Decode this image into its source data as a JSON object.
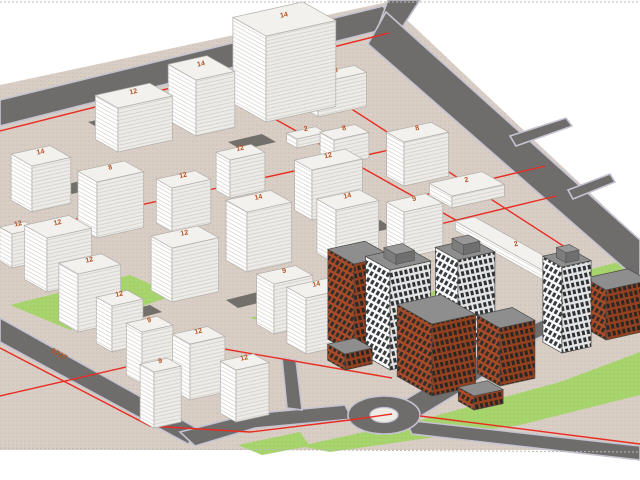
{
  "viewport": {
    "width": 640,
    "height": 480,
    "background": "#ffffff",
    "tool": "3d-massing-model-view"
  },
  "palette": {
    "ground": "#d8cec5",
    "ground_dot": "#c8bbaf",
    "road": "#6e6d6c",
    "road_edge": "#c6c3d0",
    "grass": "#a8d46d",
    "grass_dot": "#97c75c",
    "parcel_line": "#e92c22",
    "massing_top": "#f3f1ee",
    "massing_left": "#ffffff",
    "massing_right": "#edebe8",
    "massing_stroke": "#b3afaa",
    "floor_line": "#d3d0cb",
    "detail_roof": "#8e8e8e",
    "detail_stroke": "#4a4a48",
    "white_facade": "#fafafa",
    "white_window": "#3a3d40",
    "brick_facade": "#a84b28",
    "brick_window": "#332e29",
    "shadow": "#615f5a",
    "label_orange": "#b4531f",
    "frame_dash": "#bdbab6",
    "island_fill": "#efece7"
  },
  "scene": {
    "axes": {
      "u": [
        0.97,
        -0.215
      ],
      "v": [
        0.87,
        0.49
      ]
    },
    "frame_lines": [
      {
        "name": "frame-dash-top",
        "x1": 0,
        "y1": 2,
        "x2": 640,
        "y2": 2
      },
      {
        "name": "frame-dash-bottom",
        "x1": 0,
        "y1": 448,
        "x2": 640,
        "y2": 452
      }
    ],
    "terrain": {
      "name": "terrain",
      "pts": [
        [
          0,
          85
        ],
        [
          388,
          2
        ],
        [
          640,
          240
        ],
        [
          640,
          450
        ],
        [
          0,
          450
        ]
      ]
    },
    "grass": [
      {
        "name": "grass-left",
        "pts": [
          [
            10,
            305
          ],
          [
            130,
            275
          ],
          [
            175,
            295
          ],
          [
            70,
            330
          ]
        ]
      },
      {
        "name": "grass-center",
        "pts": [
          [
            250,
            318
          ],
          [
            350,
            295
          ],
          [
            420,
            310
          ],
          [
            330,
            340
          ]
        ]
      },
      {
        "name": "grass-court",
        "pts": [
          [
            415,
            296
          ],
          [
            462,
            283
          ],
          [
            482,
            295
          ],
          [
            432,
            310
          ]
        ]
      },
      {
        "name": "grass-se-wedge",
        "pts": [
          [
            300,
            446
          ],
          [
            420,
            420
          ],
          [
            560,
            382
          ],
          [
            640,
            352
          ],
          [
            640,
            395
          ],
          [
            520,
            425
          ],
          [
            400,
            442
          ],
          [
            330,
            452
          ]
        ]
      },
      {
        "name": "grass-east",
        "pts": [
          [
            588,
            270
          ],
          [
            640,
            256
          ],
          [
            640,
            300
          ],
          [
            600,
            292
          ]
        ]
      },
      {
        "name": "grass-south-small",
        "pts": [
          [
            238,
            445
          ],
          [
            300,
            432
          ],
          [
            310,
            446
          ],
          [
            262,
            455
          ]
        ]
      }
    ],
    "roads": [
      {
        "name": "road-northwest",
        "pts": [
          [
            0,
            100
          ],
          [
            383,
            6
          ],
          [
            397,
            26
          ],
          [
            0,
            126
          ]
        ]
      },
      {
        "name": "road-north-exit",
        "pts": [
          [
            377,
            30
          ],
          [
            388,
            0
          ],
          [
            420,
            0
          ],
          [
            399,
            32
          ]
        ]
      },
      {
        "name": "road-east-main",
        "pts": [
          [
            386,
            12
          ],
          [
            640,
            240
          ],
          [
            640,
            282
          ],
          [
            368,
            44
          ]
        ]
      },
      {
        "name": "road-stub-1",
        "pts": [
          [
            510,
            136
          ],
          [
            566,
            118
          ],
          [
            572,
            126
          ],
          [
            516,
            146
          ]
        ]
      },
      {
        "name": "road-stub-2",
        "pts": [
          [
            568,
            190
          ],
          [
            610,
            174
          ],
          [
            615,
            182
          ],
          [
            573,
            199
          ]
        ]
      },
      {
        "name": "road-southwest",
        "pts": [
          [
            0,
            318
          ],
          [
            200,
            430
          ],
          [
            188,
            444
          ],
          [
            0,
            342
          ]
        ]
      },
      {
        "name": "road-to-roundabout-west",
        "pts": [
          [
            180,
            432
          ],
          [
            250,
            414
          ],
          [
            345,
            405
          ],
          [
            352,
            419
          ],
          [
            255,
            428
          ],
          [
            195,
            446
          ]
        ]
      },
      {
        "name": "road-inner-branch",
        "pts": [
          [
            282,
            358
          ],
          [
            296,
            360
          ],
          [
            302,
            410
          ],
          [
            287,
            408
          ]
        ]
      },
      {
        "name": "road-northeast-exit",
        "pts": [
          [
            398,
            404
          ],
          [
            458,
            368
          ],
          [
            520,
            330
          ],
          [
            560,
            312
          ],
          [
            605,
            302
          ],
          [
            640,
            302
          ],
          [
            640,
            318
          ],
          [
            608,
            316
          ],
          [
            564,
            326
          ],
          [
            526,
            344
          ],
          [
            470,
            386
          ],
          [
            414,
            420
          ]
        ]
      },
      {
        "name": "road-southeast-exit",
        "pts": [
          [
            405,
            420
          ],
          [
            640,
            446
          ],
          [
            640,
            460
          ],
          [
            412,
            434
          ]
        ]
      }
    ],
    "roundabout": {
      "name": "roundabout",
      "cx": 384,
      "cy": 415,
      "rx": 36,
      "ry": 19,
      "island_rx": 14,
      "island_ry": 7.5
    },
    "shadows": [
      {
        "pts": [
          [
            88,
            122
          ],
          [
            128,
            113
          ],
          [
            142,
            121
          ],
          [
            102,
            130
          ]
        ]
      },
      {
        "pts": [
          [
            228,
            142
          ],
          [
            262,
            134
          ],
          [
            276,
            142
          ],
          [
            242,
            150
          ]
        ]
      },
      {
        "pts": [
          [
            60,
            186
          ],
          [
            92,
            178
          ],
          [
            104,
            186
          ],
          [
            72,
            194
          ]
        ]
      },
      {
        "pts": [
          [
            150,
            258
          ],
          [
            184,
            250
          ],
          [
            196,
            258
          ],
          [
            162,
            266
          ]
        ]
      },
      {
        "pts": [
          [
            226,
            300
          ],
          [
            258,
            292
          ],
          [
            270,
            300
          ],
          [
            238,
            308
          ]
        ]
      },
      {
        "pts": [
          [
            120,
            312
          ],
          [
            150,
            305
          ],
          [
            162,
            312
          ],
          [
            132,
            320
          ]
        ]
      },
      {
        "pts": [
          [
            348,
            228
          ],
          [
            380,
            220
          ],
          [
            392,
            228
          ],
          [
            360,
            236
          ]
        ]
      },
      {
        "pts": [
          [
            206,
            366
          ],
          [
            236,
            358
          ],
          [
            248,
            366
          ],
          [
            218,
            374
          ]
        ]
      }
    ],
    "parcel_lines": [
      {
        "name": "parcel-line-nw",
        "pts": [
          [
            0,
            131
          ],
          [
            389,
            33
          ]
        ]
      },
      {
        "name": "parcel-line-mid-u",
        "pts": [
          [
            0,
            236
          ],
          [
            430,
            141
          ]
        ]
      },
      {
        "name": "parcel-line-center-v",
        "pts": [
          [
            205,
            80
          ],
          [
            470,
            228
          ]
        ]
      },
      {
        "name": "parcel-line-east-v",
        "pts": [
          [
            316,
            86
          ],
          [
            585,
            260
          ]
        ]
      },
      {
        "name": "parcel-line-sw-road",
        "pts": [
          [
            0,
            348
          ],
          [
            150,
            426
          ],
          [
            250,
            432
          ],
          [
            350,
            420
          ],
          [
            392,
            414
          ]
        ]
      },
      {
        "name": "parcel-line-south-u",
        "pts": [
          [
            0,
            396
          ],
          [
            213,
            347
          ],
          [
            392,
            378
          ]
        ]
      },
      {
        "name": "parcel-line-east-1",
        "pts": [
          [
            420,
            196
          ],
          [
            545,
            166
          ]
        ]
      },
      {
        "name": "parcel-line-east-2",
        "pts": [
          [
            432,
            226
          ],
          [
            556,
            196
          ]
        ]
      },
      {
        "name": "parcel-line-se-road",
        "pts": [
          [
            420,
            416
          ],
          [
            640,
            444
          ]
        ]
      },
      {
        "name": "parcel-line-se-green",
        "pts": [
          [
            556,
            330
          ],
          [
            640,
            292
          ]
        ]
      }
    ],
    "ground_label": {
      "text": "0727",
      "x": 50,
      "y": 352,
      "angle": 30
    },
    "buildings": [
      {
        "name": "block-nw-1",
        "kind": "massing",
        "label": "12",
        "c": [
          118,
          152
        ],
        "dl": 26,
        "dr": 56,
        "h": 44
      },
      {
        "name": "tower-n-2",
        "kind": "massing",
        "label": "14",
        "c": [
          196,
          136
        ],
        "dl": 32,
        "dr": 40,
        "h": 56
      },
      {
        "name": "tower-n-main",
        "kind": "massing",
        "label": "14",
        "c": [
          266,
          122
        ],
        "dl": 38,
        "dr": 72,
        "h": 86
      },
      {
        "name": "slab-n-8",
        "kind": "massing",
        "label": "8",
        "c": [
          318,
          117
        ],
        "dl": 14,
        "dr": 50,
        "h": 34
      },
      {
        "name": "podium-n-2",
        "kind": "massing",
        "label": "2",
        "c": [
          297,
          148
        ],
        "dl": 12,
        "dr": 30,
        "h": 9
      },
      {
        "name": "slab-n-8b",
        "kind": "massing",
        "label": "8",
        "c": [
          334,
          166
        ],
        "dl": 16,
        "dr": 36,
        "h": 26
      },
      {
        "name": "slab-ne-8",
        "kind": "massing",
        "label": "8",
        "c": [
          404,
          186
        ],
        "dl": 20,
        "dr": 46,
        "h": 44
      },
      {
        "name": "block-w-14",
        "kind": "massing",
        "label": "14",
        "c": [
          32,
          212
        ],
        "dl": 24,
        "dr": 40,
        "h": 46
      },
      {
        "name": "block-w-8",
        "kind": "massing",
        "label": "8",
        "c": [
          97,
          238
        ],
        "dl": 22,
        "dr": 48,
        "h": 56
      },
      {
        "name": "block-c-12a",
        "kind": "massing",
        "label": "12",
        "c": [
          172,
          232
        ],
        "dl": 18,
        "dr": 40,
        "h": 44
      },
      {
        "name": "block-w-12b",
        "kind": "massing",
        "label": "12",
        "c": [
          47,
          292
        ],
        "dl": 26,
        "dr": 46,
        "h": 54
      },
      {
        "name": "block-w-12c",
        "kind": "massing",
        "label": "12",
        "c": [
          78,
          332
        ],
        "dl": 22,
        "dr": 44,
        "h": 58
      },
      {
        "name": "block-c-12d",
        "kind": "massing",
        "label": "12",
        "c": [
          172,
          302
        ],
        "dl": 24,
        "dr": 48,
        "h": 54
      },
      {
        "name": "block-c-14a",
        "kind": "massing",
        "label": "14",
        "c": [
          247,
          272
        ],
        "dl": 24,
        "dr": 46,
        "h": 60
      },
      {
        "name": "block-c-12e",
        "kind": "massing",
        "label": "12",
        "c": [
          312,
          220
        ],
        "dl": 20,
        "dr": 52,
        "h": 50
      },
      {
        "name": "block-c-14b",
        "kind": "massing",
        "label": "14",
        "c": [
          336,
          264
        ],
        "dl": 22,
        "dr": 44,
        "h": 54
      },
      {
        "name": "block-e-9",
        "kind": "massing",
        "label": "9",
        "c": [
          404,
          258
        ],
        "dl": 20,
        "dr": 40,
        "h": 46
      },
      {
        "name": "block-s-9a",
        "kind": "massing",
        "label": "9",
        "c": [
          274,
          334
        ],
        "dl": 20,
        "dr": 40,
        "h": 50
      },
      {
        "name": "block-s-14",
        "kind": "massing",
        "label": "14",
        "c": [
          306,
          354
        ],
        "dl": 22,
        "dr": 42,
        "h": 56
      },
      {
        "name": "tower-sw-12a",
        "kind": "massing",
        "label": "12",
        "c": [
          112,
          352
        ],
        "dl": 18,
        "dr": 32,
        "h": 46
      },
      {
        "name": "tower-sw-9",
        "kind": "massing",
        "label": "9",
        "c": [
          142,
          384
        ],
        "dl": 18,
        "dr": 32,
        "h": 52
      },
      {
        "name": "tower-sw-12b",
        "kind": "massing",
        "label": "12",
        "c": [
          190,
          400
        ],
        "dl": 20,
        "dr": 36,
        "h": 56
      },
      {
        "name": "tower-sw-12c",
        "kind": "massing",
        "label": "12",
        "c": [
          236,
          422
        ],
        "dl": 18,
        "dr": 34,
        "h": 52
      },
      {
        "name": "tower-sw-9b",
        "kind": "massing",
        "label": "9",
        "c": [
          154,
          428
        ],
        "dl": 16,
        "dr": 28,
        "h": 56
      },
      {
        "name": "block-c-12f",
        "kind": "massing",
        "label": "12",
        "c": [
          230,
          198
        ],
        "dl": 16,
        "dr": 36,
        "h": 38
      },
      {
        "name": "slab-e-long-2",
        "kind": "massing",
        "label": "2",
        "c": [
          558,
          288
        ],
        "dl": 118,
        "dr": 20,
        "h": 9
      },
      {
        "name": "slab-e-2b",
        "kind": "massing",
        "label": "2",
        "c": [
          452,
          208
        ],
        "dl": 26,
        "dr": 54,
        "h": 12
      },
      {
        "name": "block-w-edge",
        "kind": "massing",
        "label": "12",
        "c": [
          12,
          268
        ],
        "dl": 14,
        "dr": 26,
        "h": 34
      },
      {
        "name": "res-tower-1",
        "kind": "detail-white",
        "label": "",
        "c": [
          390,
          370
        ],
        "dl": 28,
        "dr": 42,
        "h": 100,
        "penthouse": true
      },
      {
        "name": "res-brick-1",
        "kind": "detail-brick",
        "label": "",
        "c": [
          354,
          354
        ],
        "dl": 30,
        "dr": 38,
        "h": 90
      },
      {
        "name": "res-brick-2",
        "kind": "detail-brick",
        "label": "",
        "c": [
          432,
          396
        ],
        "dl": 40,
        "dr": 45,
        "h": 72
      },
      {
        "name": "res-tower-2",
        "kind": "detail-white",
        "label": "",
        "c": [
          458,
          348
        ],
        "dl": 26,
        "dr": 38,
        "h": 88,
        "penthouse": true
      },
      {
        "name": "res-brick-3",
        "kind": "detail-brick",
        "label": "",
        "c": [
          500,
          386
        ],
        "dl": 26,
        "dr": 36,
        "h": 58
      },
      {
        "name": "res-tower-3",
        "kind": "detail-white",
        "label": "",
        "c": [
          562,
          353
        ],
        "dl": 22,
        "dr": 30,
        "h": 86,
        "penthouse": true
      },
      {
        "name": "res-brick-4",
        "kind": "detail-brick",
        "label": "",
        "c": [
          606,
          340
        ],
        "dl": 24,
        "dr": 44,
        "h": 50
      },
      {
        "name": "res-wing-1",
        "kind": "detail-brick",
        "label": "",
        "c": [
          345,
          370
        ],
        "dl": 20,
        "dr": 28,
        "h": 16
      },
      {
        "name": "res-wing-2",
        "kind": "detail-brick",
        "label": "",
        "c": [
          474,
          410
        ],
        "dl": 18,
        "dr": 30,
        "h": 14
      }
    ]
  }
}
